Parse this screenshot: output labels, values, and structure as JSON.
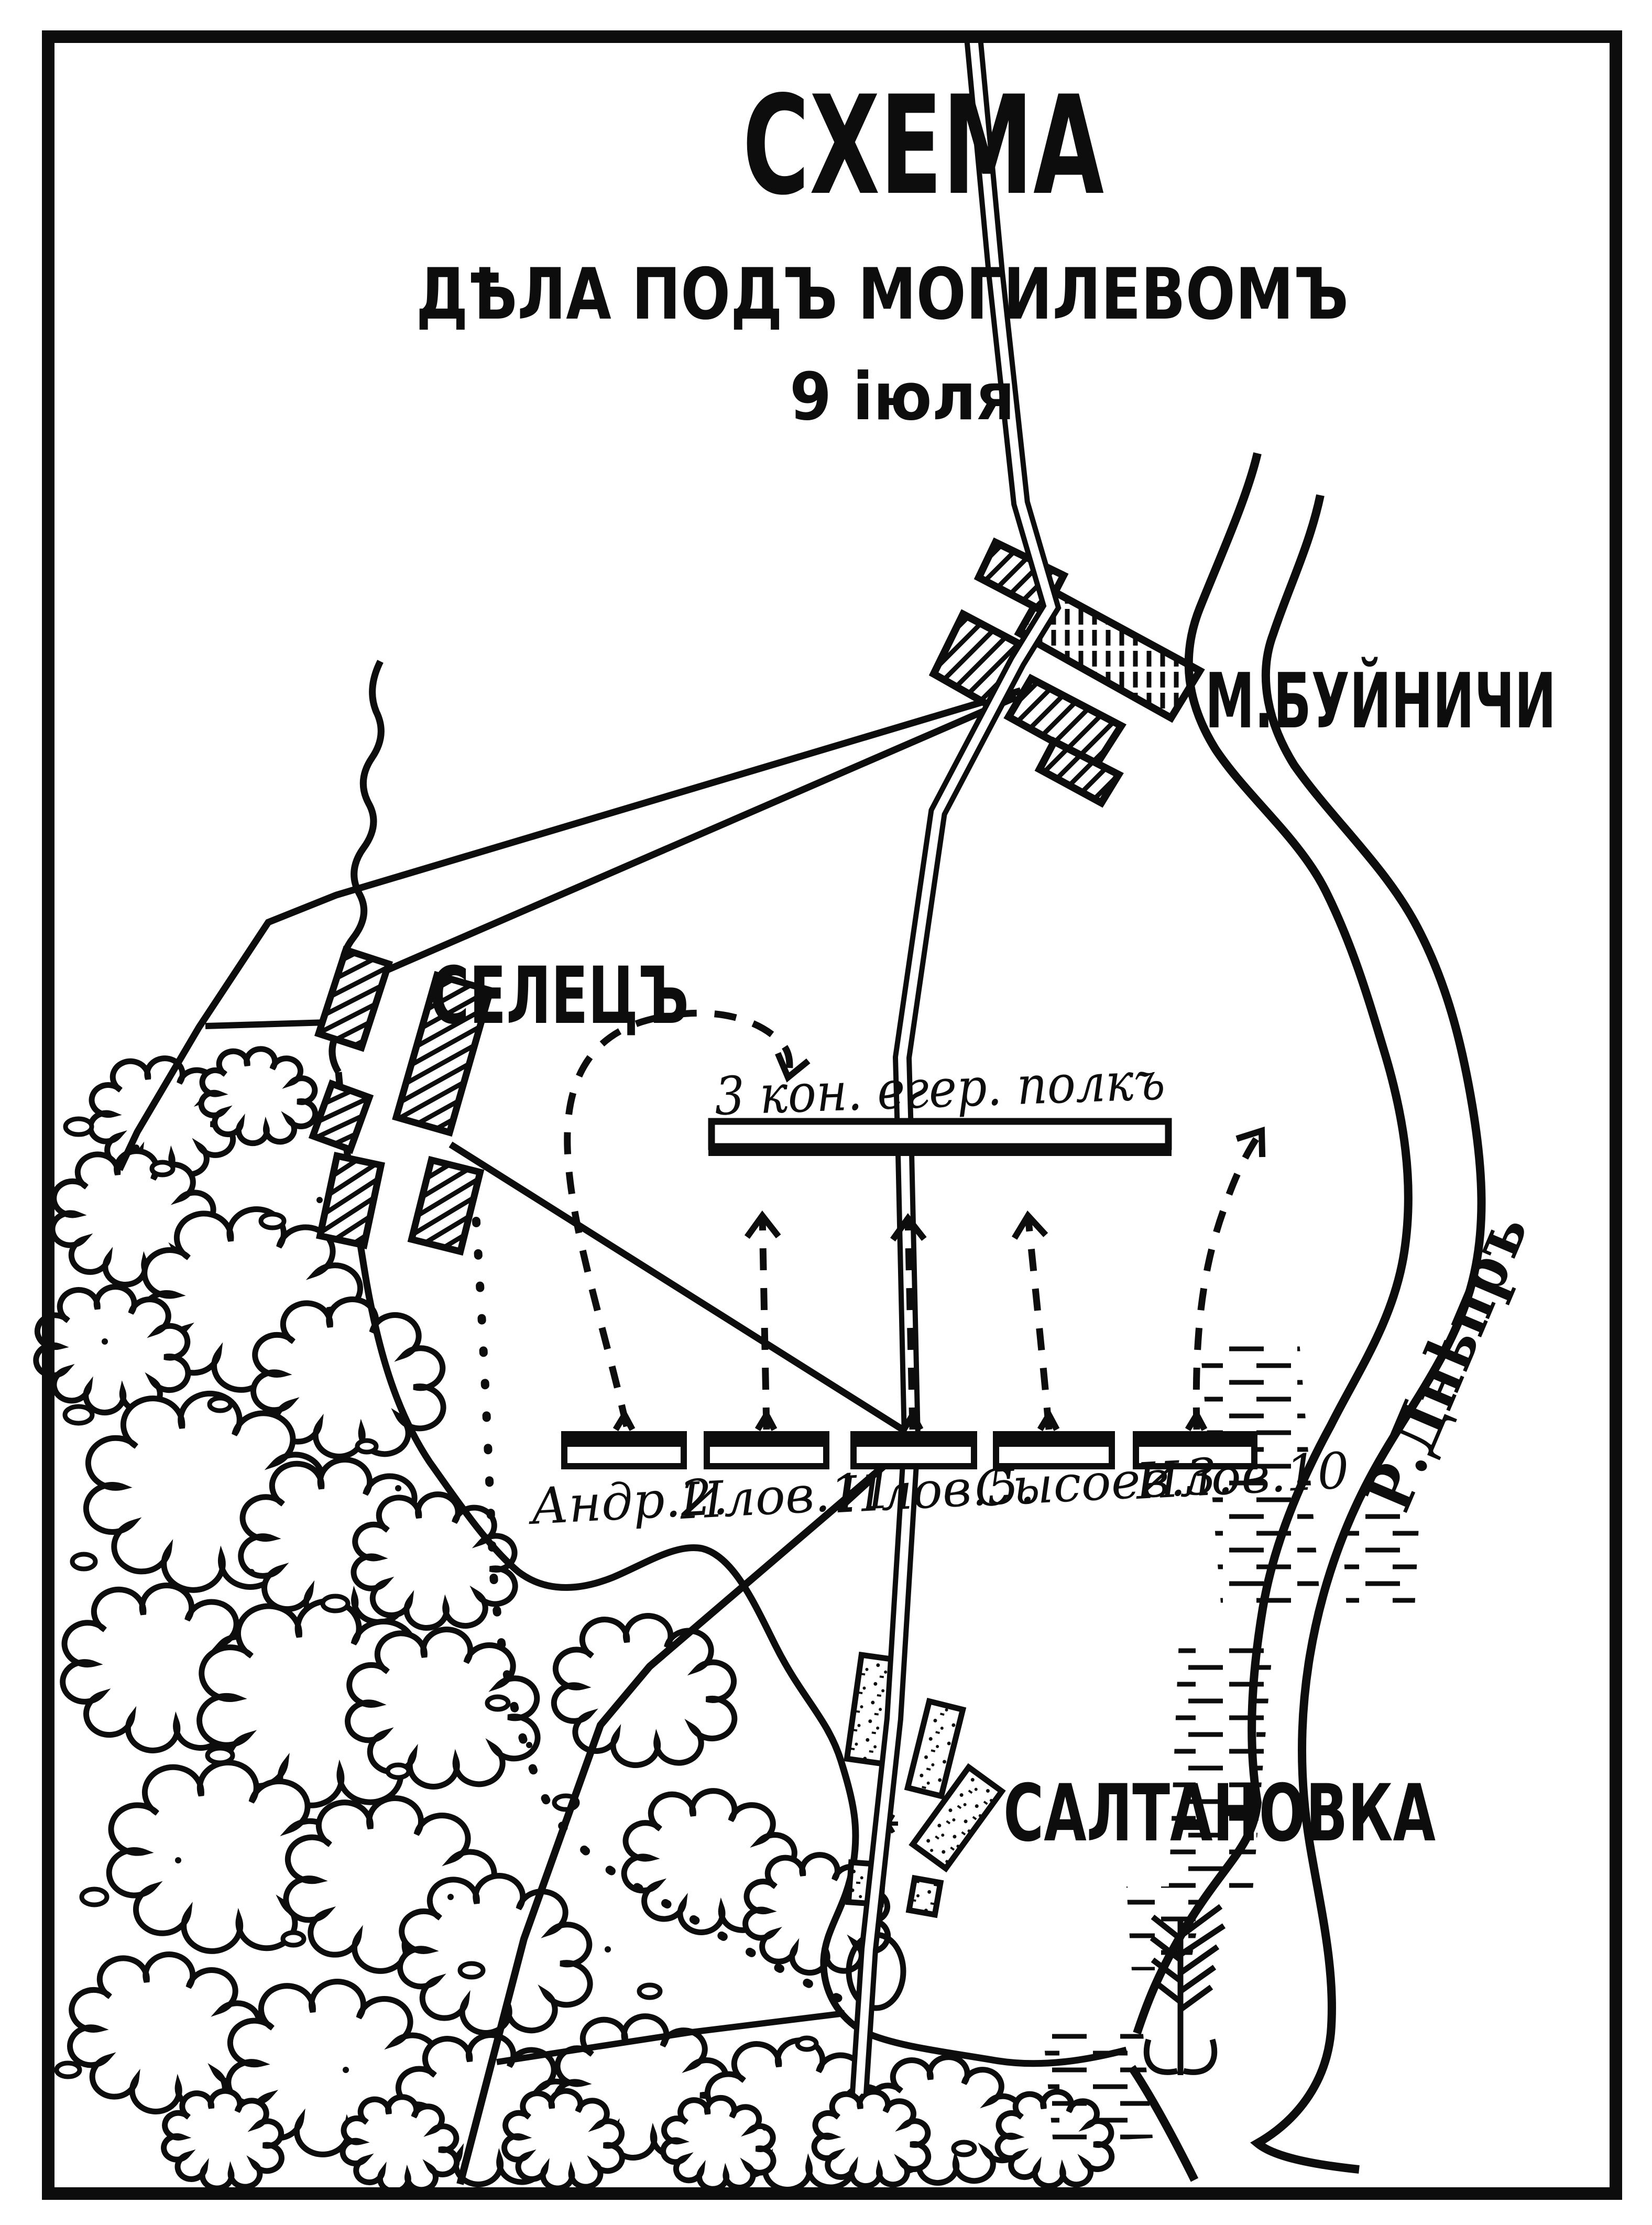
{
  "map": {
    "title": "СХЕМА",
    "subtitle": "ДѢЛА ПОДЪ МОГИЛЕВОМЪ",
    "date_line": "9 іюля"
  },
  "places": {
    "buinichi": "М.БУЙНИЧИ",
    "selets": "СЕЛЕЦЪ",
    "saltanovka": "САЛТАНОВКА",
    "river_dnieper": "Р.Днѣпръ"
  },
  "units": {
    "horse_jaeger_regiment": "3 кон. егер. полкъ",
    "cossack_regiments": [
      "Андр.2.",
      "Илов.11.",
      "Илов.5.",
      "Сысоев.3.",
      "Илов.10"
    ]
  },
  "symbols": {
    "troop_bar": "regiment-position-bar",
    "dashed_arrow": "attack-direction-arrow",
    "river_flow": "downstream-flow-arrow",
    "hatched_block": "built-up-village-block",
    "cloud": "forest-area",
    "marsh": "marsh-hatching"
  },
  "colors": {
    "ink": "#0d0d0d",
    "paper": "#ffffff"
  }
}
